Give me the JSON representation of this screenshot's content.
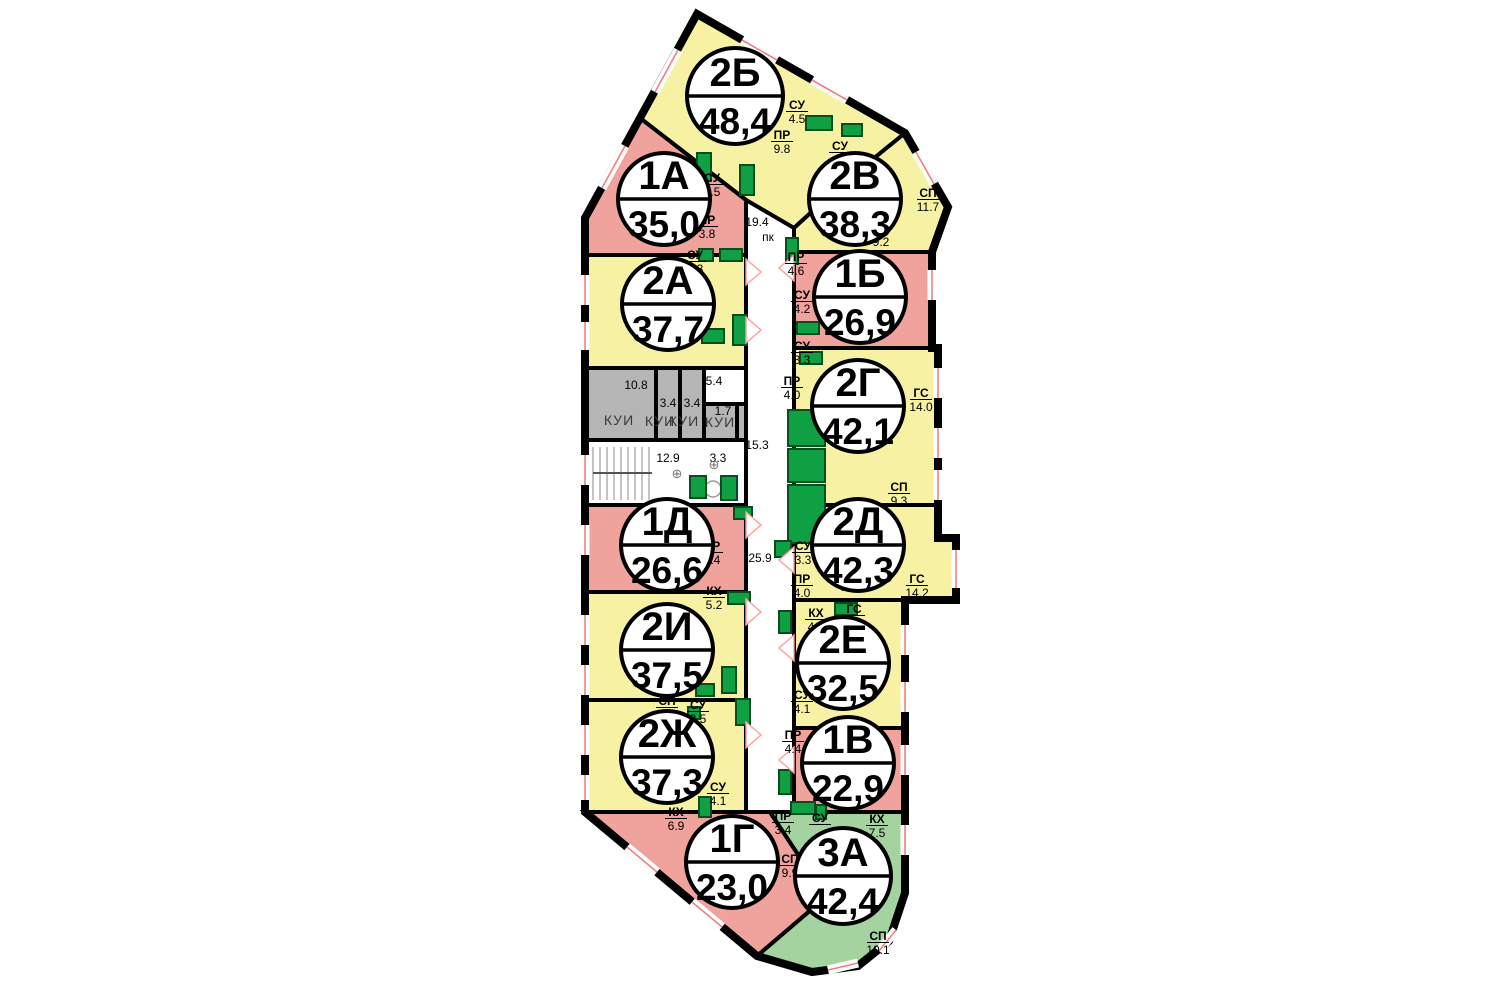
{
  "plan_title": "floor-plan",
  "colors": {
    "wall": "#000000",
    "yellow": "#F7F2A3",
    "pink": "#F0A29D",
    "green_unit": "#A5D3A0",
    "gray": "#B5B5B5",
    "white": "#FFFFFF",
    "fixture": "#0FA044",
    "fixture_border": "#074D20",
    "window_red": "#F08080",
    "door_pink": "#FF9C9C",
    "badge_fill": "#FFFFFF",
    "badge_stroke": "#000000"
  },
  "badges": [
    {
      "type": "2Б",
      "area": "48,4",
      "cx": 735,
      "cy": 96,
      "r": 48
    },
    {
      "type": "1А",
      "area": "35,0",
      "cx": 664,
      "cy": 199,
      "r": 46
    },
    {
      "type": "2В",
      "area": "38,3",
      "cx": 855,
      "cy": 199,
      "r": 46
    },
    {
      "type": "2А",
      "area": "37,7",
      "cx": 668,
      "cy": 304,
      "r": 46
    },
    {
      "type": "1Б",
      "area": "26,9",
      "cx": 860,
      "cy": 297,
      "r": 46
    },
    {
      "type": "2Г",
      "area": "42,1",
      "cx": 858,
      "cy": 406,
      "r": 46
    },
    {
      "type": "1Д",
      "area": "26,6",
      "cx": 667,
      "cy": 545,
      "r": 46
    },
    {
      "type": "2Д",
      "area": "42,3",
      "cx": 858,
      "cy": 545,
      "r": 46
    },
    {
      "type": "2И",
      "area": "37,5",
      "cx": 667,
      "cy": 650,
      "r": 46
    },
    {
      "type": "2Е",
      "area": "32,5",
      "cx": 843,
      "cy": 663,
      "r": 46
    },
    {
      "type": "2Ж",
      "area": "37,3",
      "cx": 667,
      "cy": 757,
      "r": 46
    },
    {
      "type": "1В",
      "area": "22,9",
      "cx": 848,
      "cy": 763,
      "r": 46
    },
    {
      "type": "1Г",
      "area": "23,0",
      "cx": 732,
      "cy": 862,
      "r": 46
    },
    {
      "type": "3А",
      "area": "42,4",
      "cx": 843,
      "cy": 876,
      "r": 48
    }
  ],
  "units": [
    {
      "name": "unit-2b",
      "fill": "yellow",
      "points": [
        [
          640,
          118
        ],
        [
          697,
          14
        ],
        [
          905,
          133
        ],
        [
          840,
          186
        ],
        [
          794,
          228
        ],
        [
          746,
          200
        ]
      ]
    },
    {
      "name": "unit-1a",
      "fill": "pink",
      "points": [
        [
          585,
          255
        ],
        [
          585,
          218
        ],
        [
          640,
          118
        ],
        [
          746,
          200
        ],
        [
          746,
          255
        ]
      ]
    },
    {
      "name": "unit-2v",
      "fill": "yellow",
      "points": [
        [
          794,
          228
        ],
        [
          840,
          186
        ],
        [
          905,
          133
        ],
        [
          948,
          207
        ],
        [
          932,
          252
        ],
        [
          794,
          252
        ]
      ]
    },
    {
      "name": "unit-2a",
      "fill": "yellow",
      "points": [
        [
          585,
          368
        ],
        [
          585,
          255
        ],
        [
          746,
          255
        ],
        [
          746,
          368
        ]
      ]
    },
    {
      "name": "utility-kui-block",
      "fill": "gray",
      "points": [
        [
          585,
          440
        ],
        [
          585,
          368
        ],
        [
          746,
          368
        ],
        [
          746,
          440
        ]
      ]
    },
    {
      "name": "stair-lobby",
      "fill": "white",
      "points": [
        [
          585,
          505
        ],
        [
          585,
          440
        ],
        [
          746,
          440
        ],
        [
          746,
          505
        ]
      ]
    },
    {
      "name": "unit-1d",
      "fill": "pink",
      "points": [
        [
          585,
          592
        ],
        [
          585,
          505
        ],
        [
          746,
          505
        ],
        [
          746,
          592
        ]
      ]
    },
    {
      "name": "unit-2i",
      "fill": "yellow",
      "points": [
        [
          585,
          700
        ],
        [
          585,
          592
        ],
        [
          746,
          592
        ],
        [
          746,
          700
        ]
      ]
    },
    {
      "name": "unit-2zh",
      "fill": "yellow",
      "points": [
        [
          585,
          812
        ],
        [
          585,
          700
        ],
        [
          746,
          700
        ],
        [
          746,
          812
        ]
      ]
    },
    {
      "name": "unit-1g",
      "fill": "pink",
      "points": [
        [
          585,
          812
        ],
        [
          770,
          812
        ],
        [
          826,
          897
        ],
        [
          757,
          956
        ]
      ]
    },
    {
      "name": "unit-3a",
      "fill": "green_unit",
      "points": [
        [
          770,
          812
        ],
        [
          905,
          812
        ],
        [
          905,
          893
        ],
        [
          889,
          941
        ],
        [
          858,
          966
        ],
        [
          812,
          972
        ],
        [
          757,
          956
        ],
        [
          826,
          897
        ]
      ]
    },
    {
      "name": "unit-1b",
      "fill": "pink",
      "points": [
        [
          794,
          252
        ],
        [
          932,
          252
        ],
        [
          932,
          348
        ],
        [
          794,
          348
        ]
      ]
    },
    {
      "name": "unit-2g",
      "fill": "yellow",
      "points": [
        [
          794,
          348
        ],
        [
          938,
          348
        ],
        [
          938,
          505
        ],
        [
          794,
          505
        ]
      ]
    },
    {
      "name": "unit-2d",
      "fill": "yellow",
      "points": [
        [
          794,
          505
        ],
        [
          938,
          505
        ],
        [
          938,
          538
        ],
        [
          956,
          538
        ],
        [
          956,
          600
        ],
        [
          794,
          600
        ]
      ]
    },
    {
      "name": "unit-2e",
      "fill": "yellow",
      "points": [
        [
          794,
          600
        ],
        [
          905,
          600
        ],
        [
          905,
          728
        ],
        [
          794,
          728
        ]
      ]
    },
    {
      "name": "unit-1v",
      "fill": "pink",
      "points": [
        [
          794,
          728
        ],
        [
          905,
          728
        ],
        [
          905,
          812
        ],
        [
          794,
          812
        ]
      ]
    },
    {
      "name": "corridor",
      "fill": "white",
      "points": [
        [
          746,
          200
        ],
        [
          794,
          228
        ],
        [
          794,
          812
        ],
        [
          746,
          812
        ]
      ]
    },
    {
      "name": "kui-room-54",
      "fill": "white",
      "points": [
        [
          704,
          368
        ],
        [
          746,
          368
        ],
        [
          746,
          404
        ],
        [
          704,
          404
        ]
      ]
    }
  ],
  "outline": [
    [
      697,
      14
    ],
    [
      905,
      133
    ],
    [
      948,
      207
    ],
    [
      932,
      252
    ],
    [
      932,
      348
    ],
    [
      938,
      348
    ],
    [
      938,
      538
    ],
    [
      956,
      538
    ],
    [
      956,
      600
    ],
    [
      905,
      600
    ],
    [
      905,
      893
    ],
    [
      889,
      941
    ],
    [
      858,
      966
    ],
    [
      812,
      972
    ],
    [
      757,
      956
    ],
    [
      585,
      812
    ],
    [
      585,
      218
    ],
    [
      640,
      118
    ]
  ],
  "inner_lines": [
    [
      656,
      368,
      656,
      440
    ],
    [
      680,
      368,
      680,
      440
    ],
    [
      704,
      368,
      704,
      440
    ],
    [
      704,
      404,
      746,
      404
    ],
    [
      737,
      404,
      737,
      440
    ]
  ],
  "windows": [
    [
      585,
      275,
      585,
      305
    ],
    [
      585,
      322,
      585,
      350
    ],
    [
      585,
      455,
      585,
      485
    ],
    [
      585,
      525,
      585,
      555
    ],
    [
      585,
      615,
      585,
      645
    ],
    [
      585,
      665,
      585,
      695
    ],
    [
      585,
      725,
      585,
      755
    ],
    [
      585,
      775,
      585,
      800
    ],
    [
      602,
      188,
      625,
      146
    ],
    [
      655,
      92,
      678,
      50
    ],
    [
      742,
      40,
      777,
      60
    ],
    [
      812,
      80,
      847,
      100
    ],
    [
      916,
      152,
      934,
      184
    ],
    [
      932,
      270,
      932,
      300
    ],
    [
      938,
      368,
      938,
      398
    ],
    [
      938,
      428,
      938,
      458
    ],
    [
      938,
      470,
      938,
      500
    ],
    [
      956,
      550,
      956,
      588
    ],
    [
      905,
      625,
      905,
      655
    ],
    [
      905,
      682,
      905,
      712
    ],
    [
      905,
      745,
      905,
      775
    ],
    [
      905,
      825,
      905,
      855
    ],
    [
      627,
      847,
      657,
      872
    ],
    [
      692,
      902,
      722,
      927
    ],
    [
      828,
      970,
      858,
      963
    ],
    [
      879,
      951,
      896,
      930
    ]
  ],
  "stairs": {
    "x1": 593,
    "x2": 652,
    "y1": 447,
    "y2": 500,
    "step": 7,
    "rail_y": 473
  },
  "fixtures": [
    [
      697,
      153,
      14,
      28
    ],
    [
      740,
      165,
      14,
      30
    ],
    [
      806,
      116,
      26,
      14
    ],
    [
      842,
      124,
      20,
      12
    ],
    [
      786,
      238,
      12,
      26
    ],
    [
      797,
      322,
      22,
      12
    ],
    [
      699,
      249,
      14,
      12
    ],
    [
      720,
      249,
      22,
      12
    ],
    [
      681,
      329,
      16,
      12
    ],
    [
      702,
      329,
      22,
      14
    ],
    [
      733,
      315,
      14,
      30
    ],
    [
      800,
      352,
      22,
      12
    ],
    [
      788,
      410,
      37,
      36
    ],
    [
      788,
      449,
      37,
      33
    ],
    [
      788,
      485,
      37,
      58
    ],
    [
      690,
      476,
      16,
      22
    ],
    [
      721,
      476,
      16,
      24
    ],
    [
      734,
      507,
      18,
      12
    ],
    [
      775,
      541,
      16,
      16
    ],
    [
      728,
      592,
      22,
      12
    ],
    [
      722,
      667,
      14,
      26
    ],
    [
      696,
      684,
      18,
      12
    ],
    [
      779,
      611,
      12,
      22
    ],
    [
      835,
      603,
      22,
      12
    ],
    [
      688,
      707,
      12,
      12
    ],
    [
      736,
      699,
      14,
      26
    ],
    [
      699,
      797,
      12,
      20
    ],
    [
      779,
      770,
      12,
      24
    ],
    [
      791,
      802,
      24,
      12
    ],
    [
      816,
      805,
      10,
      14
    ]
  ],
  "doors": [
    {
      "x": 746,
      "y": 272,
      "dir": 1
    },
    {
      "x": 746,
      "y": 330,
      "dir": 1
    },
    {
      "x": 746,
      "y": 525,
      "dir": 1
    },
    {
      "x": 746,
      "y": 612,
      "dir": 1
    },
    {
      "x": 746,
      "y": 735,
      "dir": 1
    },
    {
      "x": 794,
      "y": 268,
      "dir": -1
    },
    {
      "x": 794,
      "y": 560,
      "dir": -1
    },
    {
      "x": 794,
      "y": 648,
      "dir": -1
    },
    {
      "x": 794,
      "y": 760,
      "dir": -1
    }
  ],
  "room_labels": [
    {
      "name": "СУ",
      "value": "4.5",
      "x": 797,
      "y": 109
    },
    {
      "name": "ПР",
      "value": "9.8",
      "x": 782,
      "y": 139
    },
    {
      "name": "СУ",
      "value": "",
      "x": 840,
      "y": 150
    },
    {
      "name": "СП",
      "value": "11.7",
      "x": 928,
      "y": 197
    },
    {
      "name": "СУ",
      "value": "3.5",
      "x": 712,
      "y": 182
    },
    {
      "name": "ПР",
      "value": "3.8",
      "x": 707,
      "y": 224
    },
    {
      "name": "СУ",
      "value": "3.3",
      "x": 695,
      "y": 259
    },
    {
      "name": "ПР",
      "value": "4.6",
      "x": 796,
      "y": 261
    },
    {
      "name": "СУ",
      "value": "4.2",
      "x": 802,
      "y": 299
    },
    {
      "name": "СУ",
      "value": "3.3",
      "x": 802,
      "y": 350
    },
    {
      "name": "ПР",
      "value": "4.0",
      "x": 792,
      "y": 385
    },
    {
      "name": "ГС",
      "value": "14.0",
      "x": 921,
      "y": 397
    },
    {
      "name": "СП",
      "value": "9.3",
      "x": 899,
      "y": 491
    },
    {
      "name": "ПР",
      "value": "4.4",
      "x": 712,
      "y": 550
    },
    {
      "name": "СУ",
      "value": "3.3",
      "x": 803,
      "y": 550
    },
    {
      "name": "ПР",
      "value": "4.0",
      "x": 802,
      "y": 583
    },
    {
      "name": "ГС",
      "value": "14.2",
      "x": 917,
      "y": 583
    },
    {
      "name": "СП",
      "value": "",
      "x": 655,
      "y": 588
    },
    {
      "name": "КХ",
      "value": "5.2",
      "x": 714,
      "y": 595
    },
    {
      "name": "КХ",
      "value": "4.7",
      "x": 816,
      "y": 617
    },
    {
      "name": "ГС",
      "value": "",
      "x": 854,
      "y": 613
    },
    {
      "name": "СУ",
      "value": "4.1",
      "x": 802,
      "y": 699
    },
    {
      "name": "СП",
      "value": "",
      "x": 667,
      "y": 705
    },
    {
      "name": "СУ",
      "value": "3.5",
      "x": 698,
      "y": 709
    },
    {
      "name": "СУ",
      "value": "4.1",
      "x": 718,
      "y": 791
    },
    {
      "name": "КХ",
      "value": "6.9",
      "x": 676,
      "y": 816
    },
    {
      "name": "ПР",
      "value": "4.4",
      "x": 793,
      "y": 739
    },
    {
      "name": "ПР",
      "value": "3.4",
      "x": 783,
      "y": 820
    },
    {
      "name": "СП",
      "value": "9.9",
      "x": 790,
      "y": 863
    },
    {
      "name": "СУ",
      "value": "",
      "x": 820,
      "y": 822
    },
    {
      "name": "КХ",
      "value": "7.5",
      "x": 877,
      "y": 823
    },
    {
      "name": "СП",
      "value": "10.1",
      "x": 878,
      "y": 940
    }
  ],
  "plain_labels": [
    {
      "value": "19.4",
      "x": 757,
      "y": 226
    },
    {
      "value": "пк",
      "x": 768,
      "y": 241
    },
    {
      "value": "9.2",
      "x": 881,
      "y": 246
    },
    {
      "value": "10.8",
      "x": 636,
      "y": 389
    },
    {
      "value": "3.4",
      "x": 668,
      "y": 407
    },
    {
      "value": "3.4",
      "x": 692,
      "y": 407
    },
    {
      "value": "5.4",
      "x": 714,
      "y": 385
    },
    {
      "value": "1.7",
      "x": 723,
      "y": 415
    },
    {
      "value": "15.3",
      "x": 757,
      "y": 449
    },
    {
      "value": "12.9",
      "x": 668,
      "y": 462
    },
    {
      "value": "3.3",
      "x": 718,
      "y": 462
    },
    {
      "value": "25.9",
      "x": 760,
      "y": 562
    },
    {
      "value": "7.5",
      "x": 848,
      "y": 591
    },
    {
      "value": "3.8",
      "x": 695,
      "y": 682
    }
  ],
  "kui_labels": [
    {
      "value": "КУИ",
      "x": 619,
      "y": 425
    },
    {
      "value": "КУИ",
      "x": 660,
      "y": 426
    },
    {
      "value": "КУИ",
      "x": 684,
      "y": 426
    },
    {
      "value": "КУИ",
      "x": 720,
      "y": 427
    }
  ],
  "symbols": [
    {
      "value": "⊕",
      "x": 677,
      "y": 478
    },
    {
      "value": "⊕",
      "x": 714,
      "y": 469
    }
  ]
}
